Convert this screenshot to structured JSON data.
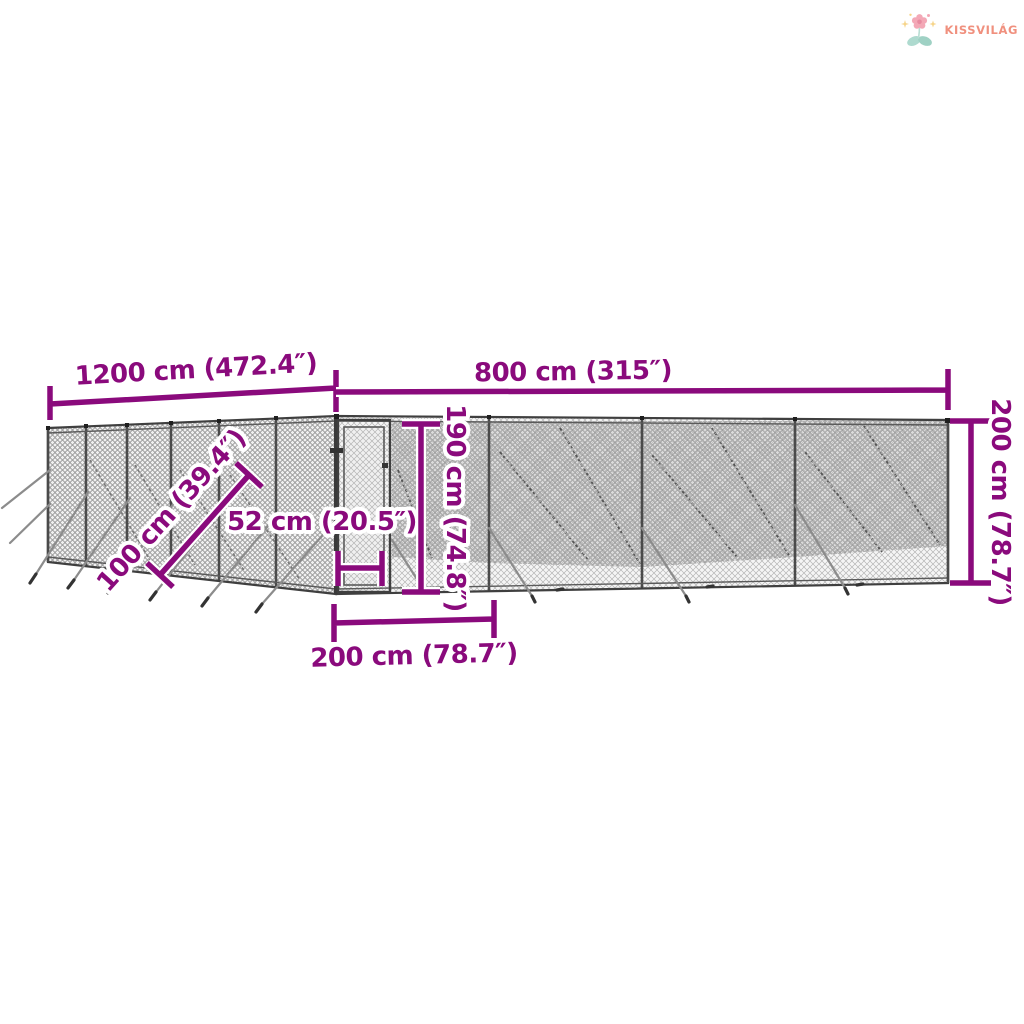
{
  "logo": {
    "brand": "KISSVILÁG",
    "colors": {
      "text": "#f0907e",
      "petal": "#f3a8b6",
      "petal_center": "#e88ba0",
      "leaf": "#a9d6cb",
      "sparkle": "#f6d488"
    }
  },
  "diagram": {
    "subject": "outdoor chain-link dog kennel wireframe, perspective view",
    "accent_color": "#8a0a7c",
    "fence_color": "#3f3f3f",
    "mesh_color_front": "#b4b4b4",
    "mesh_color_back": "#909090",
    "dimensions": {
      "length": "1200 cm (472.4″)",
      "width": "800 cm (315″)",
      "height": "200 cm (78.7″)",
      "diagonal": "100 cm (39.4″)",
      "door_width": "52 cm (20.5″)",
      "door_height": "190 cm (74.8″)",
      "door_section": "200 cm (78.7″)"
    }
  }
}
